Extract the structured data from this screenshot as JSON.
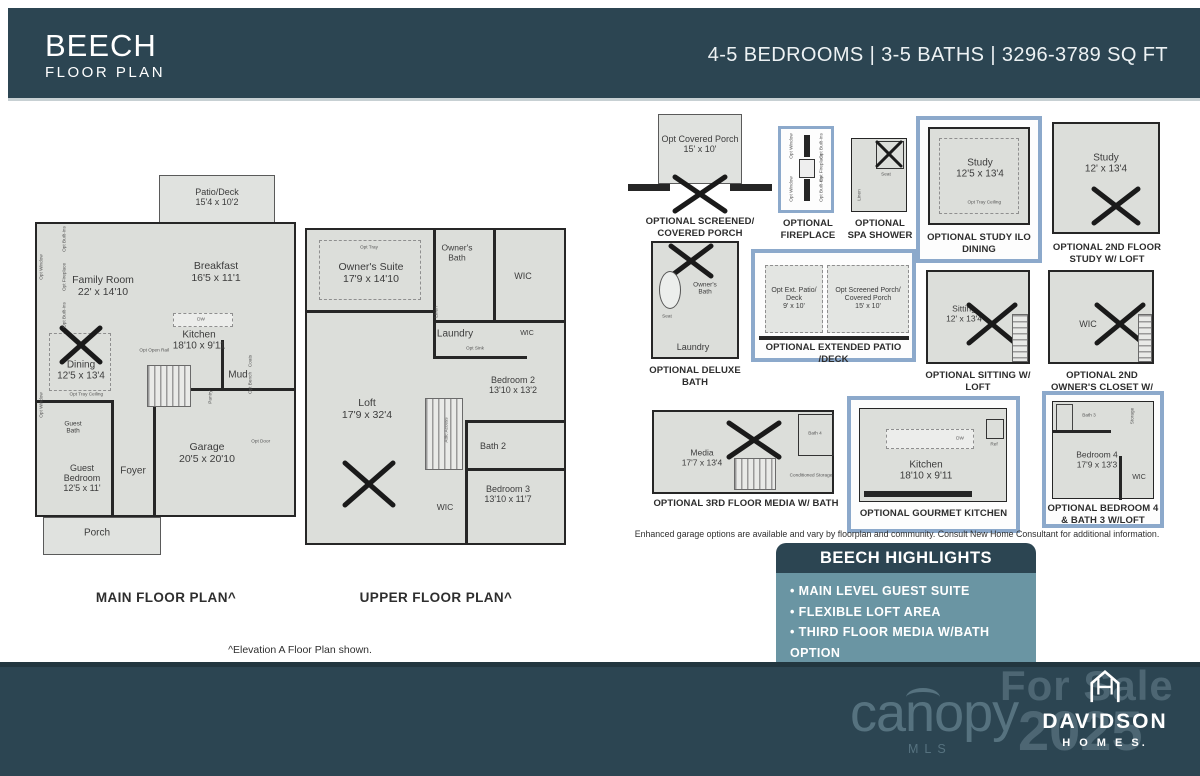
{
  "header": {
    "title": "BEECH",
    "subtitle": "FLOOR PLAN",
    "specs": "4-5 BEDROOMS | 3-5 BATHS | 3296-3789 SQ FT"
  },
  "colors": {
    "teal_dark": "#2C4552",
    "highlight_border_blue": "#8CA9CB",
    "highlights_body_teal": "#6A95A3",
    "plan_fill": "#DCDEDA",
    "wall": "#262626"
  },
  "main_floor": {
    "caption": "MAIN FLOOR PLAN^",
    "rooms": {
      "patio": {
        "name": "Patio/Deck",
        "dims": "15'4 x 10'2"
      },
      "family": {
        "name": "Family Room",
        "dims": "22' x 14'10"
      },
      "breakfast": {
        "name": "Breakfast",
        "dims": "16'5 x 11'1"
      },
      "kitchen": {
        "name": "Kitchen",
        "dims": "18'10 x 9'11"
      },
      "dining": {
        "name": "Dining",
        "dims": "12'5 x 13'4"
      },
      "guest_bath": {
        "name": "Guest Bath"
      },
      "guest_bedroom": {
        "name": "Guest Bedroom",
        "dims": "12'5 x 11'"
      },
      "foyer": {
        "name": "Foyer"
      },
      "mud": {
        "name": "Mud"
      },
      "garage": {
        "name": "Garage",
        "dims": "20'5 x 20'10"
      },
      "porch": {
        "name": "Porch"
      }
    },
    "small_labels": {
      "opt_tray_ceiling": "Opt Tray Ceiling",
      "opt_open_rail": "Opt Open Rail",
      "pantry": "Pantry",
      "opt_bench": "Opt Bench",
      "opt_door": "Opt Door",
      "coats": "Coats",
      "opt_window": "Opt Window",
      "opt_built_ins": "Opt Built-Ins",
      "opt_fireplace": "Opt Fireplace",
      "dw": "DW"
    }
  },
  "upper_floor": {
    "caption": "UPPER FLOOR PLAN^",
    "rooms": {
      "owners_suite": {
        "name": "Owner's Suite",
        "dims": "17'9 x 14'10"
      },
      "owners_bath": {
        "name": "Owner's Bath"
      },
      "wic": {
        "name": "WIC"
      },
      "laundry": {
        "name": "Laundry"
      },
      "wic2": {
        "name": "WIC"
      },
      "bedroom2": {
        "name": "Bedroom 2",
        "dims": "13'10 x 13'2"
      },
      "loft": {
        "name": "Loft",
        "dims": "17'9 x 32'4"
      },
      "bath2": {
        "name": "Bath 2"
      },
      "bedroom3": {
        "name": "Bedroom 3",
        "dims": "13'10 x 11'7"
      },
      "wic3": {
        "name": "WIC"
      }
    },
    "small_labels": {
      "opt_tray": "Opt Tray",
      "linen": "Linen",
      "opt_sink": "Opt Sink",
      "attic_access": "Attic Access"
    }
  },
  "footnote": "^Elevation A Floor Plan shown.",
  "options": [
    {
      "caption": "OPTIONAL SCREENED/ COVERED PORCH",
      "room": {
        "name": "Opt Covered Porch",
        "dims": "15' x 10'"
      }
    },
    {
      "caption": "OPTIONAL FIREPLACE",
      "labels": {
        "window": "Opt Window",
        "builtins": "Opt Built-Ins",
        "fireplace": "Opt Fireplace"
      }
    },
    {
      "caption": "OPTIONAL SPA SHOWER",
      "labels": {
        "seat": "Seat",
        "linen": "Linen"
      }
    },
    {
      "caption": "OPTIONAL STUDY ILO DINING",
      "room": {
        "name": "Study",
        "dims": "12'5 x 13'4"
      },
      "sub": "Opt Tray Ceiling"
    },
    {
      "caption": "OPTIONAL 2ND FLOOR STUDY W/ LOFT",
      "room": {
        "name": "Study",
        "dims": "12' x 13'4"
      }
    },
    {
      "caption": "OPTIONAL DELUXE BATH",
      "labels": {
        "owners_bath": "Owner's Bath",
        "seat": "Seat",
        "laundry": "Laundry"
      }
    },
    {
      "caption": "OPTIONAL EXTENDED PATIO /DECK",
      "rooms": {
        "patio": {
          "name": "Opt Ext. Patio/ Deck",
          "dims": "9' x 10'"
        },
        "porch": {
          "name": "Opt Screened Porch/ Covered Porch",
          "dims": "15' x 10'"
        }
      }
    },
    {
      "caption": "OPTIONAL SITTING W/ LOFT",
      "room": {
        "name": "Sitting",
        "dims": "12' x 13'4"
      }
    },
    {
      "caption": "OPTIONAL 2ND OWNER'S CLOSET W/ LOFT",
      "room": {
        "name": "WIC"
      }
    },
    {
      "caption": "OPTIONAL 3RD FLOOR MEDIA W/ BATH",
      "room": {
        "name": "Media",
        "dims": "17'7 x 13'4"
      },
      "labels": {
        "bath4": "Bath 4",
        "storage": "Conditioned Storage"
      }
    },
    {
      "caption": "OPTIONAL GOURMET KITCHEN",
      "room": {
        "name": "Kitchen",
        "dims": "18'10 x 9'11"
      },
      "labels": {
        "dw": "DW",
        "ref": "Ref"
      }
    },
    {
      "caption": "OPTIONAL BEDROOM 4 & BATH 3 W/LOFT",
      "room": {
        "name": "Bedroom 4",
        "dims": "17'9 x 13'3"
      },
      "labels": {
        "bath3": "Bath 3",
        "wic": "WIC",
        "storage": "Storage"
      }
    }
  ],
  "disclaimer": "Enhanced garage options are available and vary by floorplan and community.  Consult New Home Consultant for additional information.",
  "highlights": {
    "title": "BEECH HIGHLIGHTS",
    "items": [
      "MAIN LEVEL GUEST SUITE",
      "FLEXIBLE LOFT AREA",
      "THIRD FLOOR MEDIA W/BATH OPTION"
    ]
  },
  "footer": {
    "canopy": "canopy",
    "canopy_sub": "MLS",
    "for_sale": "For Sale",
    "year": "2025",
    "brand_name": "DAVIDSON",
    "brand_sub": "H O M E S."
  }
}
